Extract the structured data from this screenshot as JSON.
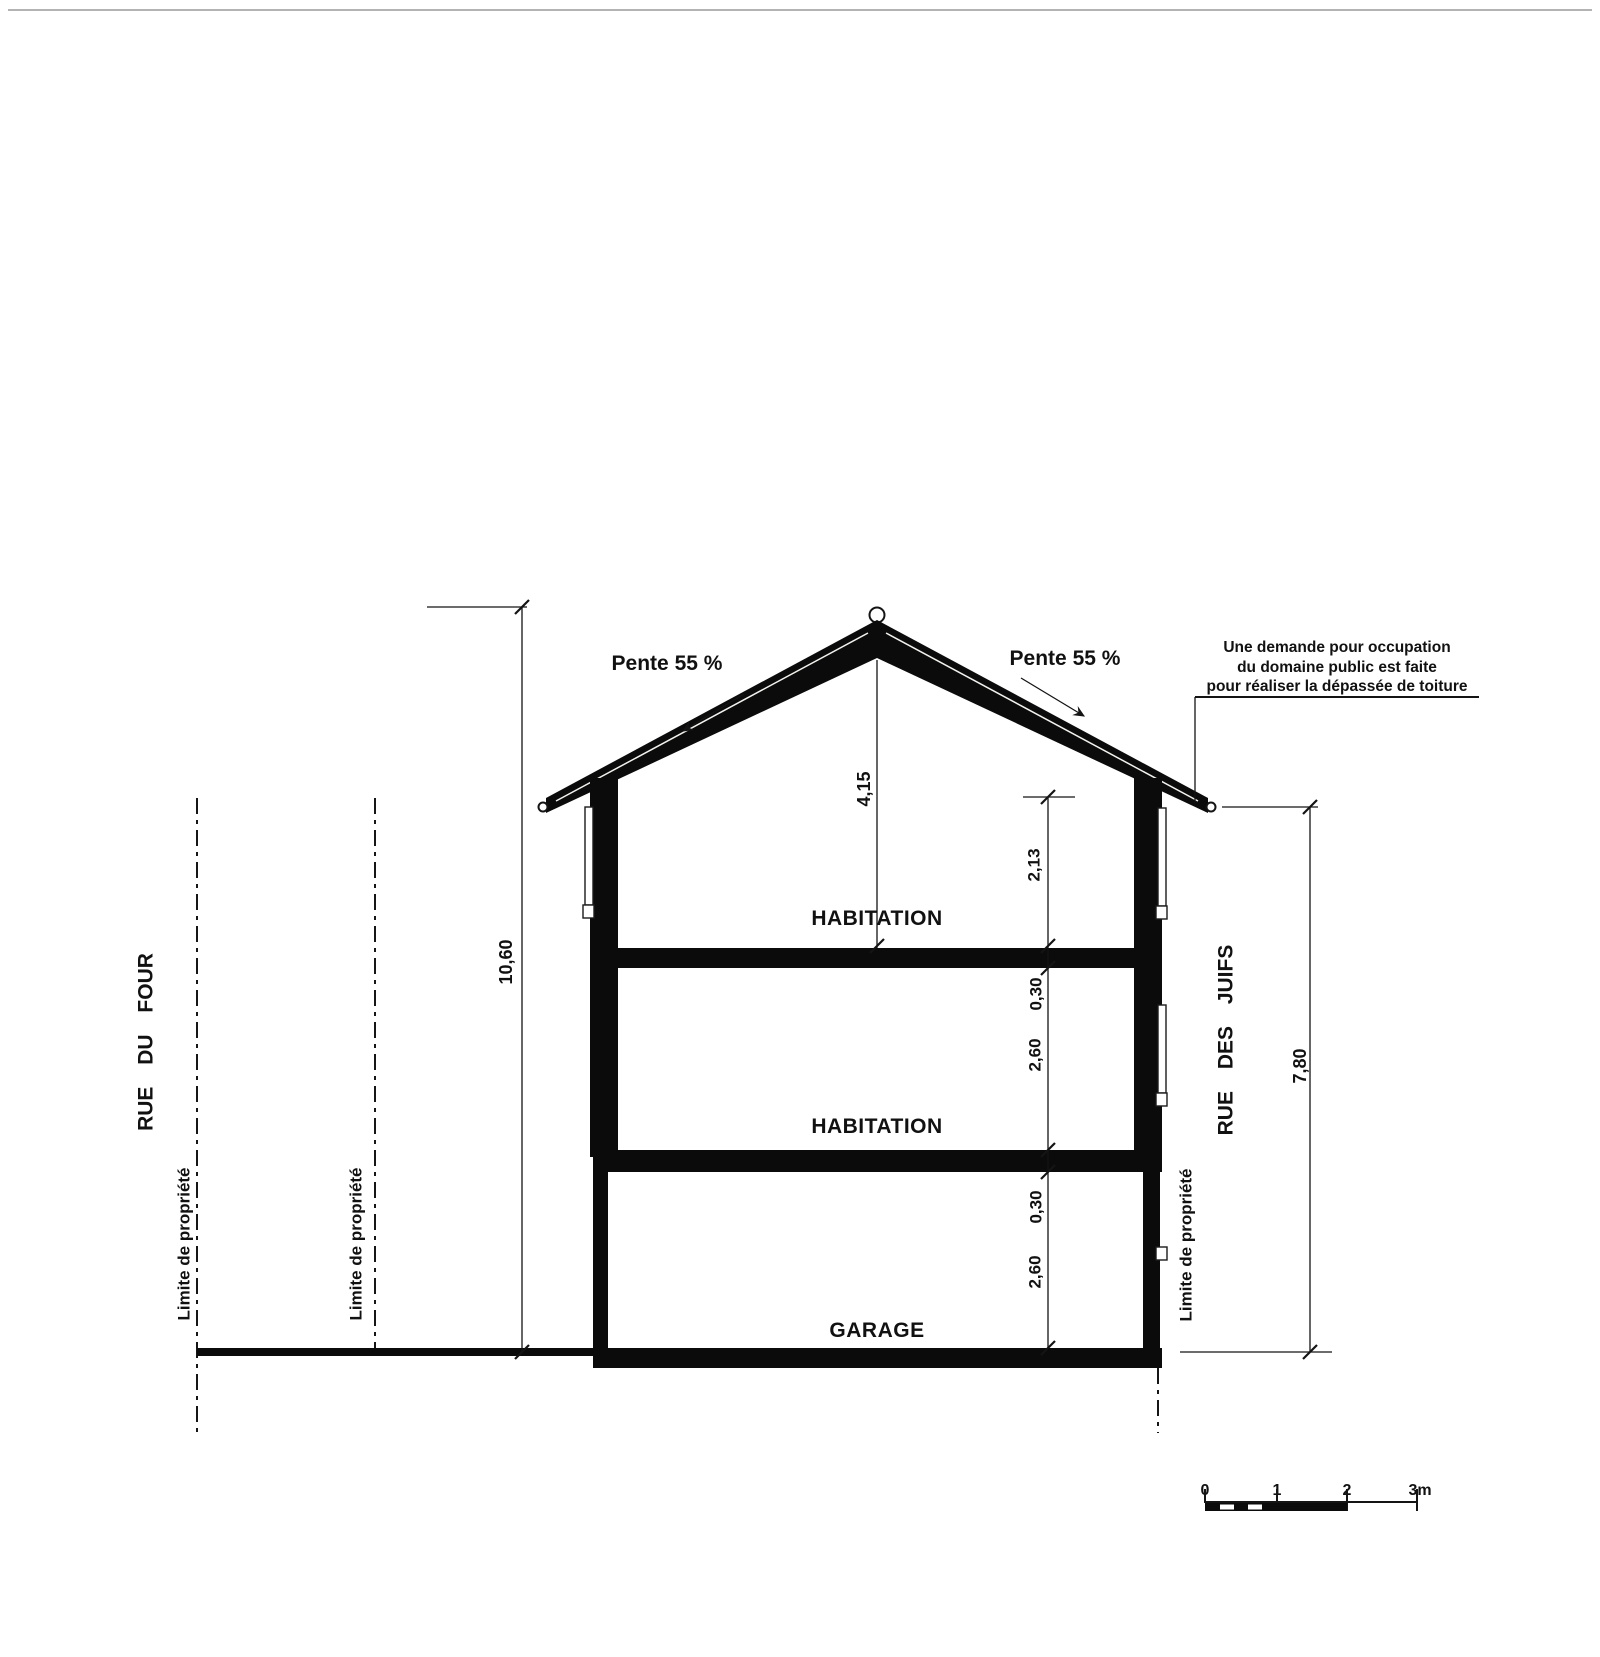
{
  "colors": {
    "ink": "#141414",
    "fill_black": "#0b0b0b",
    "page_border_gray": "#9a9a9a"
  },
  "roof": {
    "pente_left": "Pente 55 %",
    "pente_right": "Pente 55 %"
  },
  "note": {
    "line1": "Une demande pour occupation",
    "line2": "du domaine public est faite",
    "line3": "pour réaliser la dépassée de toiture"
  },
  "rooms": {
    "habitation_upper": "HABITATION",
    "habitation_lower": "HABITATION",
    "garage": "GARAGE"
  },
  "streets": {
    "left": "RUE DU FOUR",
    "right": "RUE DES JUIFS"
  },
  "limits": {
    "label": "Limite de propriété"
  },
  "dimensions": {
    "total_height": "10,60",
    "ridge_to_slab": "4,15",
    "eave_to_slab": "2,13",
    "upper_slab": "0,30",
    "upper_storey": "2,60",
    "garage_slab": "0,30",
    "garage_storey": "2,60",
    "right_facade": "7,80"
  },
  "scale_bar": {
    "labels": [
      "0",
      "1",
      "2",
      "3m"
    ]
  }
}
